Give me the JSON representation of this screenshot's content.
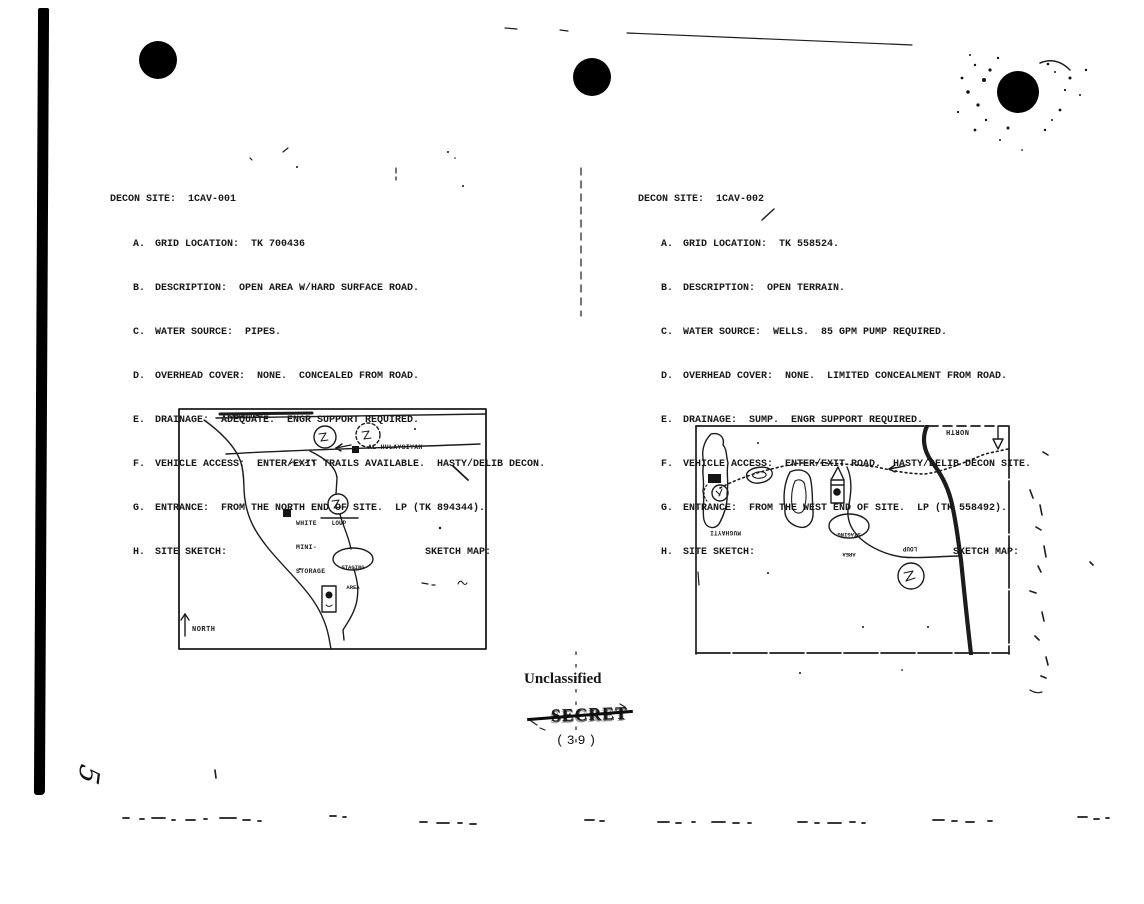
{
  "sites": [
    {
      "title": "DECON SITE:  1CAV-001",
      "items": [
        {
          "letter": "A.",
          "text": "GRID LOCATION:  TK 700436"
        },
        {
          "letter": "B.",
          "text": "DESCRIPTION:  OPEN AREA W/HARD SURFACE ROAD."
        },
        {
          "letter": "C.",
          "text": "WATER SOURCE:  PIPES."
        },
        {
          "letter": "D.",
          "text": "OVERHEAD COVER:  NONE.  CONCEALED FROM ROAD."
        },
        {
          "letter": "E.",
          "text": "DRAINAGE:  ADEQUATE.  ENGR SUPPORT REQUIRED."
        },
        {
          "letter": "F.",
          "text": "VEHICLE ACCESS:  ENTER/EXIT TRAILS AVAILABLE.  HASTY/DELIB DECON."
        },
        {
          "letter": "G.",
          "text": "ENTRANCE:  FROM THE NORTH END OF SITE.  LP (TK 894344)."
        },
        {
          "letter": "H.",
          "text": "SITE SKETCH:"
        }
      ],
      "sketch_map_label": "SKETCH MAP:",
      "map": {
        "road_label": "KAMIDH",
        "village_label": "AL HULAYSIYAH",
        "storage_label_1": "WHITE",
        "storage_label_2": "MINI-",
        "storage_label_3": "STORAGE",
        "linkup_label": "LOUP",
        "staging_label_1": "STAGING",
        "staging_label_2": "AREA",
        "north_label": "NORTH"
      }
    },
    {
      "title": "DECON SITE:  1CAV-002",
      "items": [
        {
          "letter": "A.",
          "text": "GRID LOCATION:  TK 558524."
        },
        {
          "letter": "B.",
          "text": "DESCRIPTION:  OPEN TERRAIN."
        },
        {
          "letter": "C.",
          "text": "WATER SOURCE:  WELLS.  85 GPM PUMP REQUIRED."
        },
        {
          "letter": "D.",
          "text": "OVERHEAD COVER:  NONE.  LIMITED CONCEALMENT FROM ROAD."
        },
        {
          "letter": "E.",
          "text": "DRAINAGE:  SUMP.  ENGR SUPPORT REQUIRED."
        },
        {
          "letter": "F.",
          "text": "VEHICLE ACCESS:  ENTER/EXIT ROAD.  HASTY/DELIB DECON SITE."
        },
        {
          "letter": "G.",
          "text": "ENTRANCE:  FROM THE WEST END OF SITE.  LP (TK 558492)."
        },
        {
          "letter": "H.",
          "text": "SITE SKETCH:"
        }
      ],
      "sketch_map_label": "SKETCH MAP:",
      "map": {
        "north_label": "NORTH",
        "town_label": "MUGHAYTI",
        "staging_label_1": "STAGING",
        "staging_label_2": "AREA",
        "linkup_label": "LOUP"
      }
    }
  ],
  "footer": {
    "classification": "Unclassified",
    "stamp": "SECRET",
    "page_number": "(39)",
    "handwritten_number": "5"
  },
  "colors": {
    "ink": "#1c1c1c",
    "paper": "#ffffff"
  }
}
